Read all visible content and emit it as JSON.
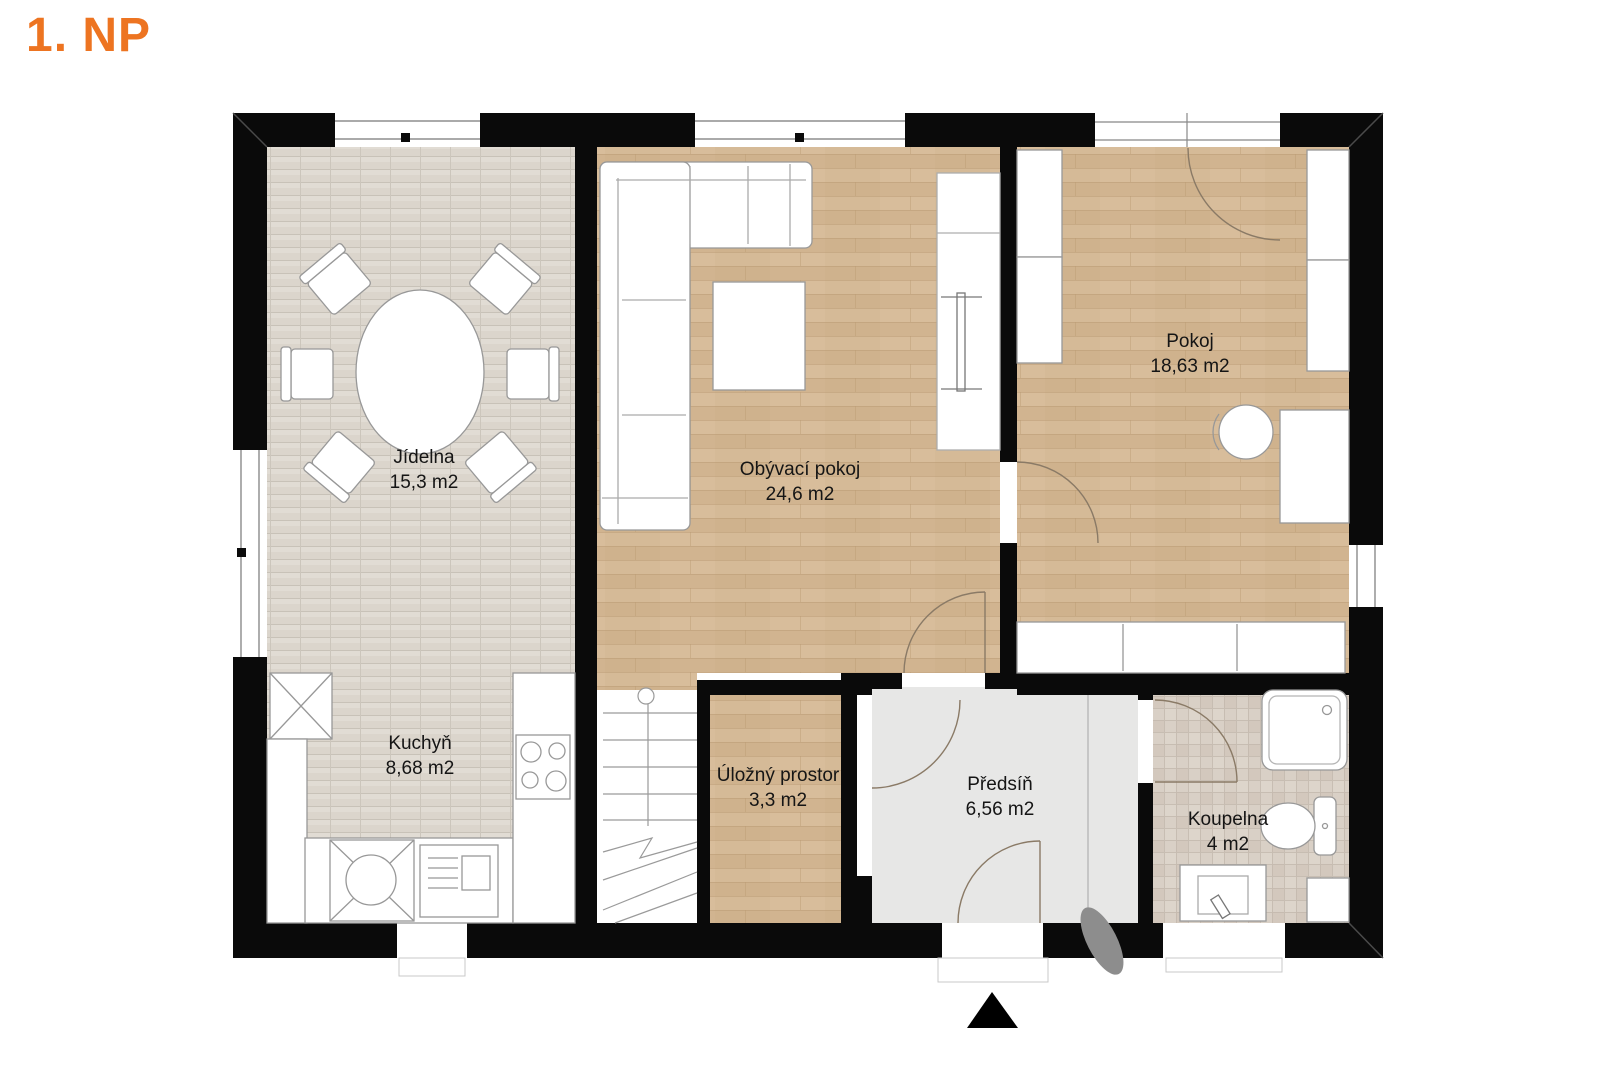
{
  "title": "1. NP",
  "colors": {
    "title_orange": "#ED7421",
    "wall_black": "#0A0A0A",
    "wood_floor": "#D3B693",
    "tile_floor": "#DBD5CC",
    "bath_tile": "#D8CFC5",
    "hall_floor": "#E7E7E6",
    "door_arc": "#8A7A66"
  },
  "rooms": [
    {
      "name": "Jídelna",
      "area": "15,3 m2"
    },
    {
      "name": "Kuchyň",
      "area": "8,68 m2"
    },
    {
      "name": "Obývací pokoj",
      "area": "24,6 m2"
    },
    {
      "name": "Pokoj",
      "area": "18,63 m2"
    },
    {
      "name": "Úložný prostor",
      "area": "3,3 m2"
    },
    {
      "name": "Předsíň",
      "area": "6,56 m2"
    },
    {
      "name": "Koupelna",
      "area": "4 m2"
    }
  ]
}
